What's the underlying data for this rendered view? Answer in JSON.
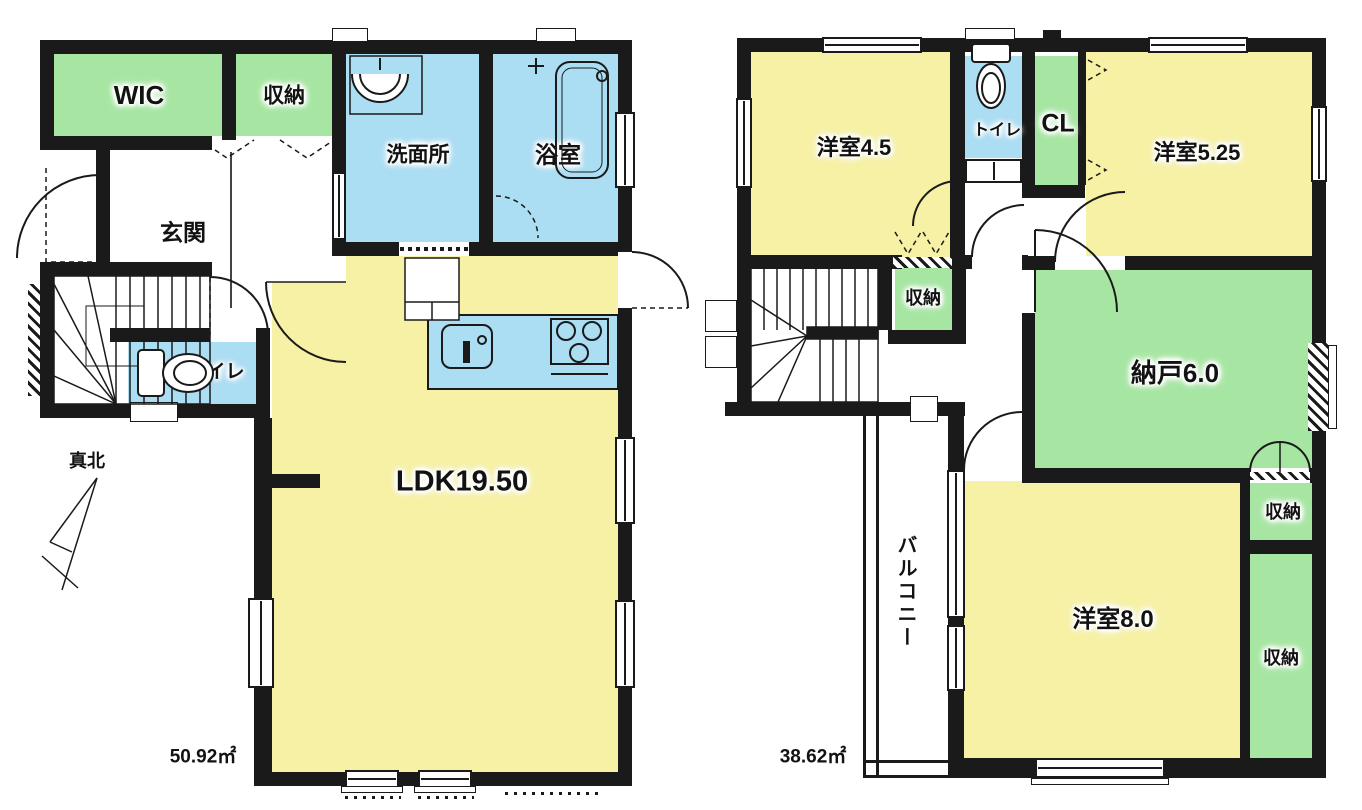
{
  "colors": {
    "room_yellow": "#F6F1A4",
    "room_green": "#A6E6A2",
    "room_blue": "#ABDDF3",
    "wall": "#1A1A1A"
  },
  "floor1": {
    "wic": "WIC",
    "storage": "収納",
    "washroom": "洗面所",
    "bathroom": "浴室",
    "entrance": "玄関",
    "toilet": "トイレ",
    "ldk": "LDK19.50",
    "north": "真北",
    "area": "50.92㎡"
  },
  "floor2": {
    "room_45": "洋室4.5",
    "toilet": "トイレ",
    "closet": "CL",
    "room_525": "洋室5.25",
    "storage_stairs": "収納",
    "storage_room": "納戸6.0",
    "storage_upper": "収納",
    "room_8": "洋室8.0",
    "storage_lower": "収納",
    "balcony": "バルコニー",
    "area": "38.62㎡"
  }
}
